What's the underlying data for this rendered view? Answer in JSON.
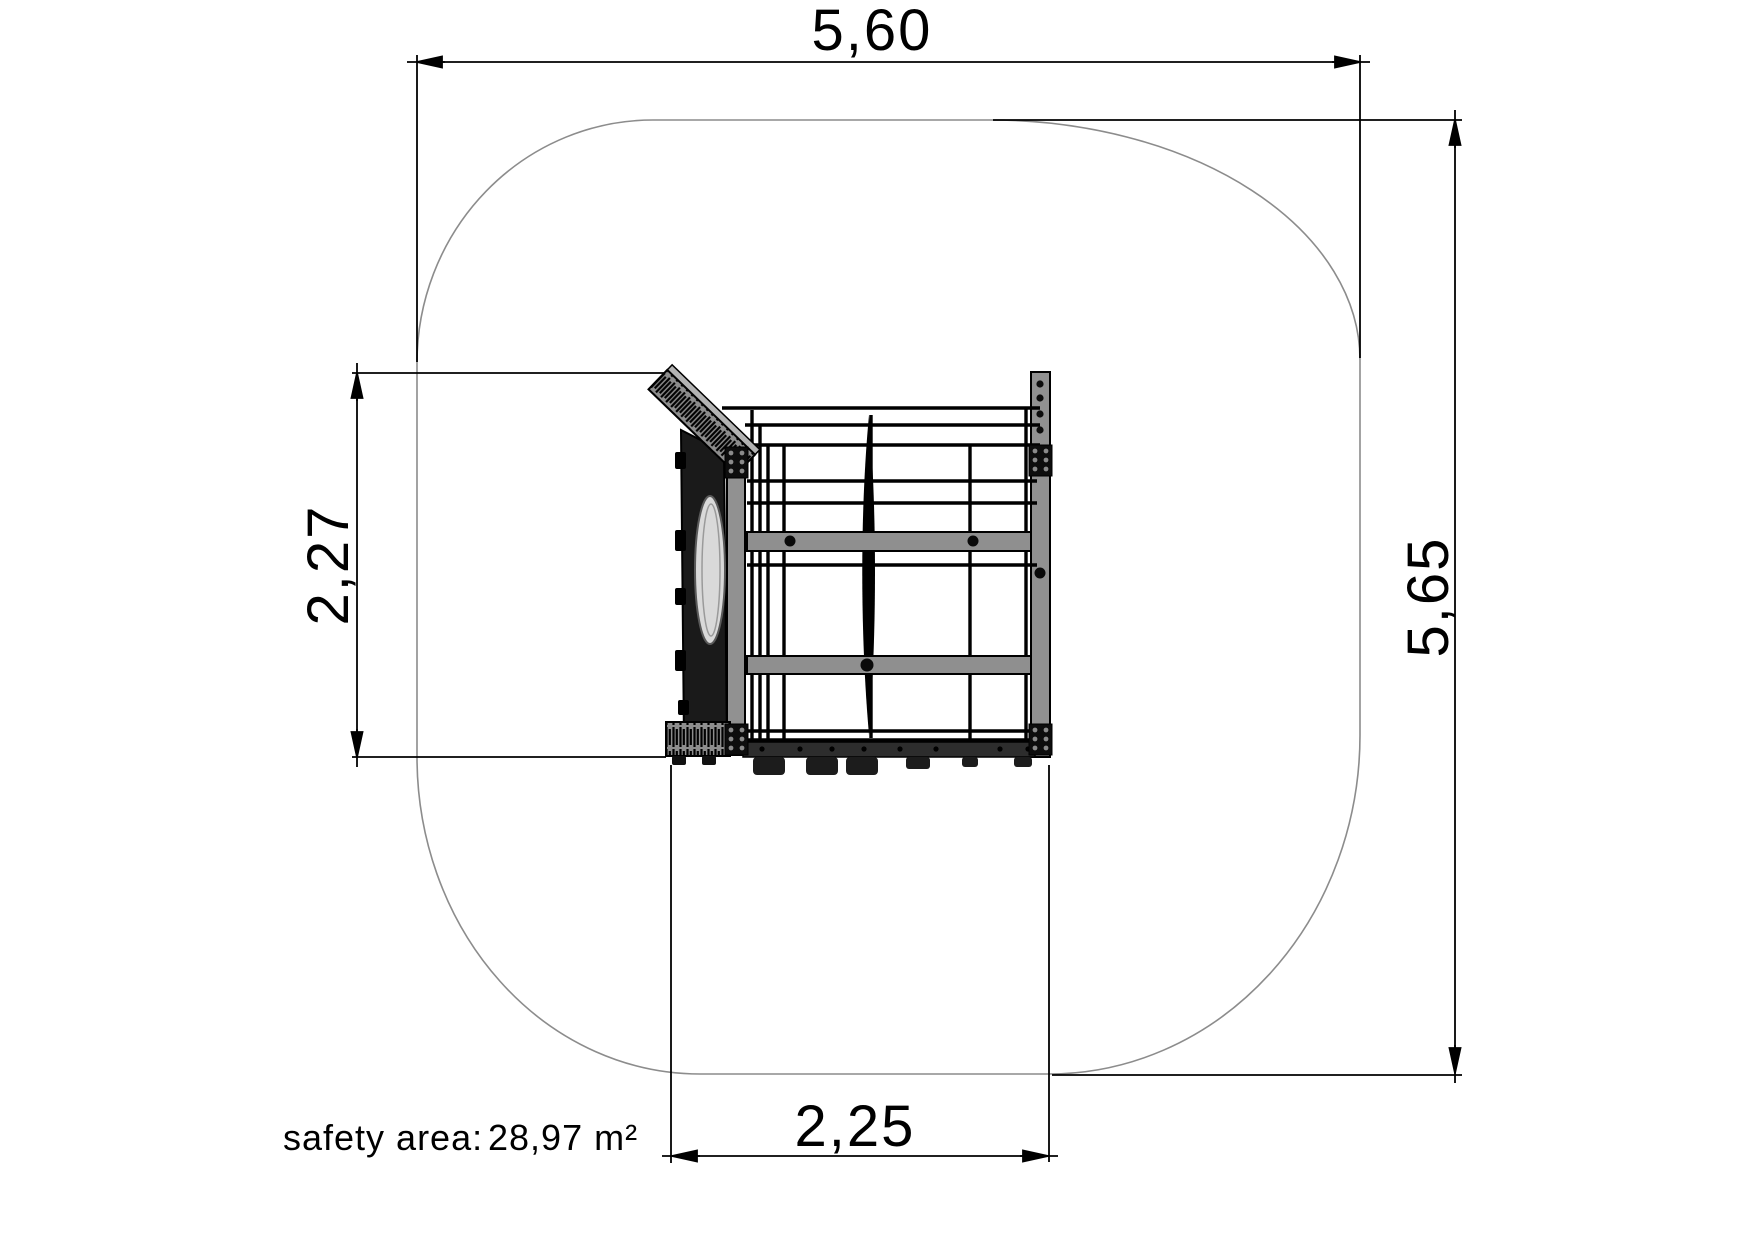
{
  "drawing": {
    "dimensions": {
      "top": {
        "value": "5,60",
        "orientation": "horizontal",
        "position": "top"
      },
      "right": {
        "value": "5,65",
        "orientation": "vertical",
        "position": "right"
      },
      "left": {
        "value": "2,27",
        "orientation": "vertical",
        "position": "left"
      },
      "bottom": {
        "value": "2,25",
        "orientation": "horizontal",
        "position": "bottom"
      }
    },
    "footer": {
      "label": "safety area:",
      "value": "28,97 m²"
    },
    "colors": {
      "ink": "#000000",
      "outline": "#8c8c8c",
      "steel": "#919191",
      "dark_panel": "#1a1a1a",
      "background": "#ffffff"
    }
  }
}
